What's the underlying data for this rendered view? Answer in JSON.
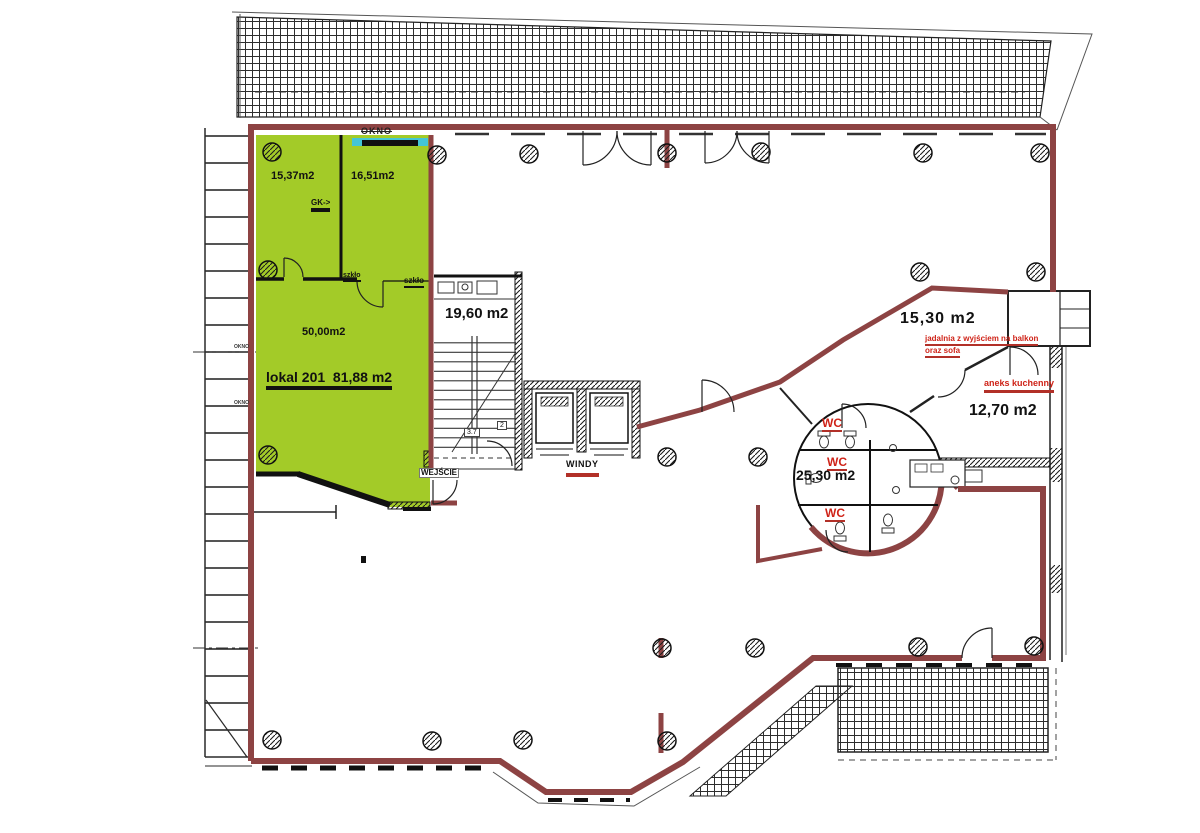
{
  "colors": {
    "wall_red": "#8d4343",
    "unit_green": "#a3cb28",
    "window_cyan": "#43c5d6",
    "label_red": "#cf2318"
  },
  "labels": {
    "okno_top": "OKNO",
    "room_1537": "15,37m2",
    "room_1651": "16,51m2",
    "gk": "GK->",
    "szklo_left": "szkło",
    "szklo_right": "szkło",
    "room_5000": "50,00m2",
    "lokal_title": "lokal 201  81,88 m2",
    "wejscie": "WEJŚCIE",
    "stairs_room": "19,60 m2",
    "dim_37": "3.7",
    "dim_2": "2",
    "windy": "WINDY",
    "room_1530": "15,30 m2",
    "jadalnia_1": "jadalnia z wyjściem na balkon",
    "jadalnia_2": "oraz sofa",
    "aneks": "aneks kuchenny",
    "room_1270": "12,70 m2",
    "wc_1": "WC",
    "wc_2": "WC",
    "wc_3": "WC",
    "room_2530": "25,30 m2",
    "okno_side_1": "OKNO",
    "okno_side_2": "OKNO"
  }
}
